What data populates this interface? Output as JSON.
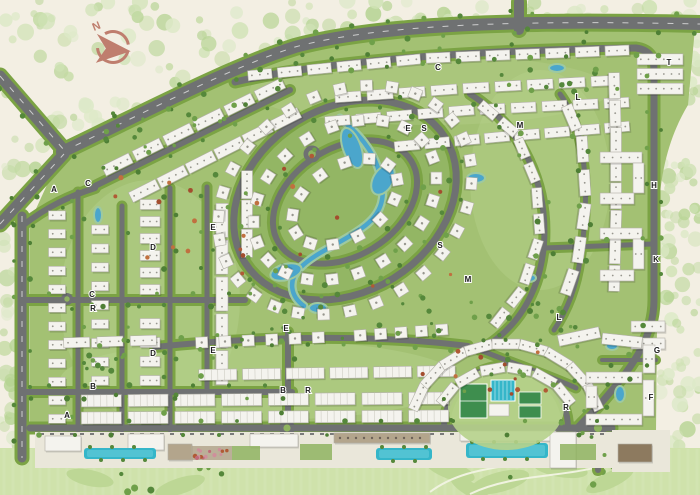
{
  "map": {
    "compass": {
      "label": "N"
    },
    "zone_markers": [
      {
        "label": "A",
        "x": 54,
        "y": 192
      },
      {
        "label": "C",
        "x": 88,
        "y": 186
      },
      {
        "label": "C",
        "x": 438,
        "y": 70
      },
      {
        "label": "E",
        "x": 408,
        "y": 131
      },
      {
        "label": "S",
        "x": 424,
        "y": 131
      },
      {
        "label": "M",
        "x": 520,
        "y": 128
      },
      {
        "label": "L",
        "x": 578,
        "y": 100
      },
      {
        "label": "T",
        "x": 669,
        "y": 65
      },
      {
        "label": "D",
        "x": 153,
        "y": 250
      },
      {
        "label": "E",
        "x": 213,
        "y": 230
      },
      {
        "label": "S",
        "x": 440,
        "y": 248
      },
      {
        "label": "M",
        "x": 468,
        "y": 282
      },
      {
        "label": "H",
        "x": 654,
        "y": 188
      },
      {
        "label": "K",
        "x": 656,
        "y": 262
      },
      {
        "label": "L",
        "x": 559,
        "y": 320
      },
      {
        "label": "C",
        "x": 92,
        "y": 297
      },
      {
        "label": "R",
        "x": 93,
        "y": 311
      },
      {
        "label": "E",
        "x": 286,
        "y": 331
      },
      {
        "label": "D",
        "x": 153,
        "y": 356
      },
      {
        "label": "E",
        "x": 213,
        "y": 353
      },
      {
        "label": "B",
        "x": 93,
        "y": 389
      },
      {
        "label": "B",
        "x": 283,
        "y": 393
      },
      {
        "label": "R",
        "x": 308,
        "y": 393
      },
      {
        "label": "A",
        "x": 67,
        "y": 418
      },
      {
        "label": "G",
        "x": 657,
        "y": 353
      },
      {
        "label": "F",
        "x": 651,
        "y": 400
      },
      {
        "label": "R",
        "x": 566,
        "y": 410
      }
    ],
    "facilities": [
      {
        "name": "football-pitch",
        "x": 473,
        "y": 401
      },
      {
        "name": "lap-pool",
        "x": 503,
        "y": 390
      },
      {
        "name": "tennis-courts",
        "x": 530,
        "y": 405
      },
      {
        "name": "clubhouse",
        "x": 499,
        "y": 410
      },
      {
        "name": "linear-pool",
        "x": 120,
        "y": 453
      },
      {
        "name": "linear-pool",
        "x": 404,
        "y": 454
      },
      {
        "name": "linear-pool",
        "x": 507,
        "y": 450
      },
      {
        "name": "central-lake",
        "x": 352,
        "y": 148
      },
      {
        "name": "stream",
        "x": 330,
        "y": 240
      },
      {
        "name": "roundabout",
        "x": 287,
        "y": 428
      },
      {
        "name": "roundabout",
        "x": 598,
        "y": 428
      },
      {
        "name": "north-compass",
        "x": 113,
        "y": 47
      }
    ],
    "colors": {
      "cream": "#f3efe3",
      "road": "#6f7172",
      "verge": "#7ba344",
      "green": "#a3c173",
      "greenLight": "#b6d18b",
      "greenDark": "#8fb360",
      "lawn": "#cfe2ab",
      "building": "#f4f3ee",
      "buildingEdge": "#b1b0a7",
      "window": "#97968e",
      "water": "#4ba6cc",
      "pool": "#35b6c9",
      "treeDark": "#55883b",
      "treeMid": "#6fa04a",
      "treeSoft": "#cfe2b4",
      "accent": "#b05a35",
      "compass": "#bf7e6e",
      "letter": "#1c1c1c",
      "strip": "#eae7da",
      "tan": "#b3a58c",
      "brown": "#8d7a5f",
      "court": "#3e8e4e"
    }
  }
}
